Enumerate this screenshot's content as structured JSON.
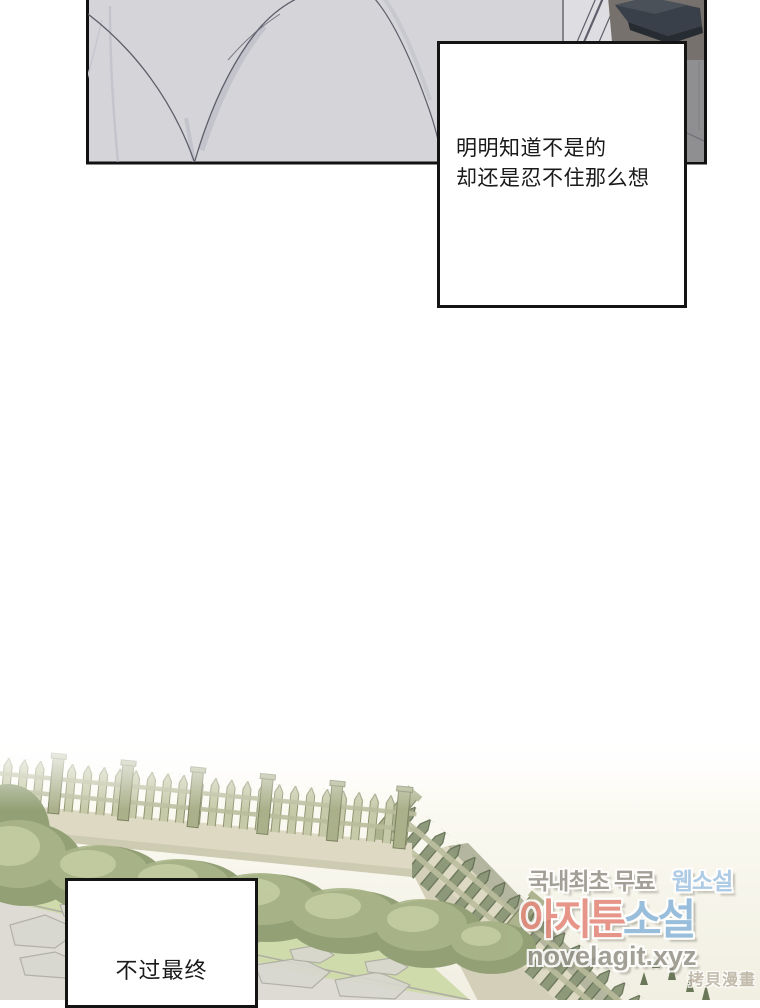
{
  "captions": {
    "top": {
      "line1": "明明知道不是的",
      "line2": "却还是忍不住那么想"
    },
    "bottom": {
      "line1": "不过最终"
    }
  },
  "watermark": {
    "line1_gray": "국내최초 무료",
    "line1_blue": "웹소설",
    "line2_coral": "아지툰",
    "line2_blue": "소설",
    "line3": "novelagit.xyz",
    "corner": "拷貝漫畫"
  },
  "colors": {
    "page_bg": "#ffffff",
    "textbox_bg": "#ffffff",
    "textbox_border": "#141414",
    "text": "#1a1a1a",
    "panel_border": "#111111",
    "fabric": "#d5d5d9",
    "fabric_light": "#dedee2",
    "fold_line": "#5f5f6b",
    "fold_soft": "#b7b7c3",
    "fold_faint": "#c6c6d0",
    "dark_bg": "#76716c",
    "dark_bg2": "#8f8f91",
    "dark_object": "#394049",
    "dark_object_top": "#4a5159",
    "dark_object_rim": "#272c33",
    "scene_sky": "#fbfaf2",
    "scene_bg": "#f1efe2",
    "picket": "#c7caa9",
    "picket_line": "#8e936f",
    "picket_b": "#8a9677",
    "picket_b_line": "#5f6b4f",
    "rail": "#b9bd9b",
    "post": "#aab08a",
    "post_line": "#7d8360",
    "wall": "#ddd9c3",
    "wall_shade": "#c8c4ac",
    "wall_face": "#b4b6a0",
    "bush_dark": "#93a076",
    "bush_mid": "#aab689",
    "bush_light": "#c6cfa4",
    "lawn": "#cfdbab",
    "path": "#dddbd4",
    "path_line": "#aeaca4",
    "path_stone": "#d8d7d0",
    "sprig": "#5c6b4a",
    "wm_gray": "#97948b",
    "wm_blue": "#a5c6e5",
    "wm_coral": "#e4897b",
    "wm_blue2": "#8db7da",
    "wm_copy": "#bdb5a6"
  }
}
